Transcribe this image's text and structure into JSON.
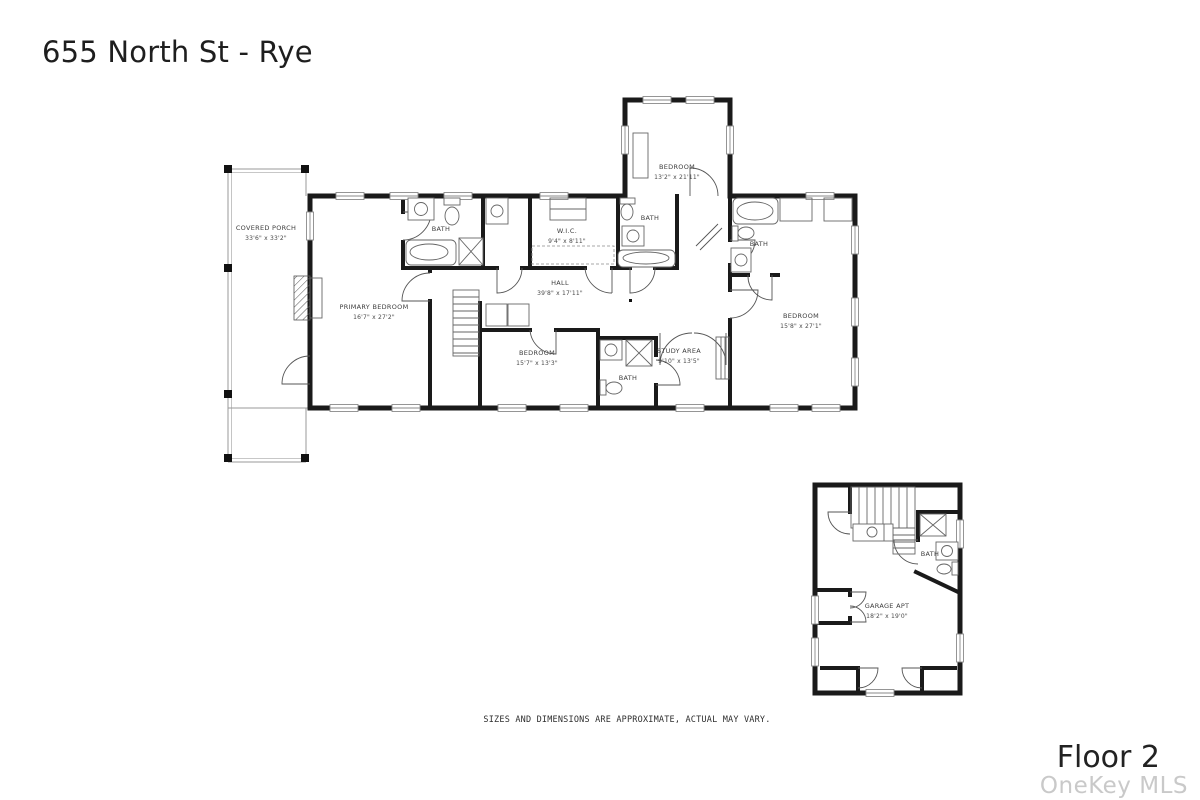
{
  "header": {
    "title": "655 North St - Rye"
  },
  "floorplan": {
    "rooms": [
      {
        "id": "covered-porch",
        "name": "COVERED PORCH",
        "dims": "33'6\" x 33'2\""
      },
      {
        "id": "primary-bedroom",
        "name": "PRIMARY BEDROOM",
        "dims": "16'7\" x 27'2\""
      },
      {
        "id": "primary-bath",
        "name": "BATH",
        "dims": ""
      },
      {
        "id": "wic",
        "name": "W.I.C.",
        "dims": "9'4\" x 8'11\""
      },
      {
        "id": "hall",
        "name": "HALL",
        "dims": "39'8\" x 17'11\""
      },
      {
        "id": "bedroom-top",
        "name": "BEDROOM",
        "dims": "13'2\" x 21'11\""
      },
      {
        "id": "bath-top",
        "name": "BATH",
        "dims": ""
      },
      {
        "id": "bath-right",
        "name": "BATH",
        "dims": ""
      },
      {
        "id": "bedroom-right",
        "name": "BEDROOM",
        "dims": "15'8\" x 27'1\""
      },
      {
        "id": "bedroom-bottom",
        "name": "BEDROOM",
        "dims": "15'7\" x 13'3\""
      },
      {
        "id": "bath-bottom",
        "name": "BATH",
        "dims": ""
      },
      {
        "id": "study-area",
        "name": "STUDY AREA",
        "dims": "9'10\" x 13'5\""
      },
      {
        "id": "garage-apt",
        "name": "GARAGE APT",
        "dims": "18'2\" x 19'0\""
      },
      {
        "id": "bath-garage",
        "name": "BATH",
        "dims": ""
      }
    ]
  },
  "footer": {
    "disclaimer": "SIZES AND DIMENSIONS ARE APPROXIMATE, ACTUAL MAY VARY.",
    "floor_label": "Floor 2",
    "watermark": "OneKey MLS"
  },
  "colors": {
    "wall": "#1a1a1a",
    "fixture_line": "#666666",
    "label_text": "#3d3d3d",
    "watermark_text": "#c9c9c9",
    "background": "#ffffff"
  }
}
